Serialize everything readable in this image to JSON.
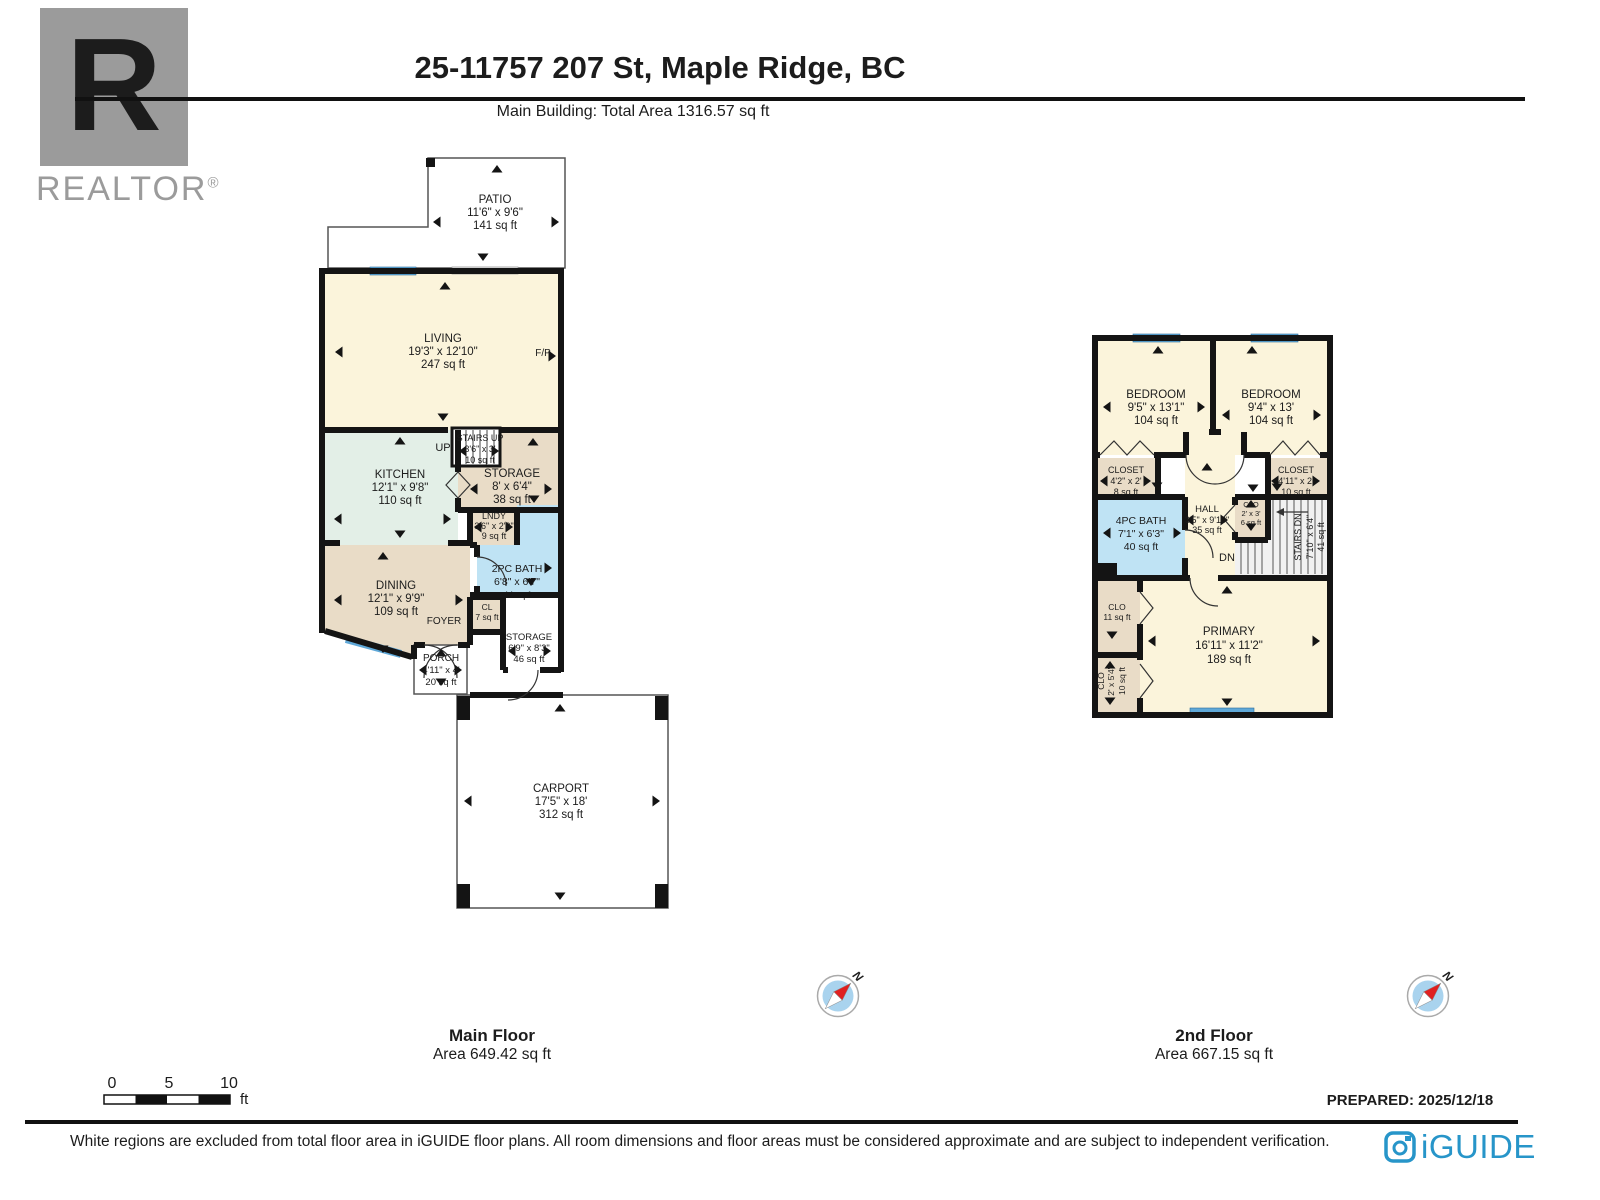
{
  "header": {
    "title": "25-11757 207 St, Maple Ridge, BC",
    "subtitle": "Main Building: Total Area 1316.57 sq ft"
  },
  "branding": {
    "realtor_r": "R",
    "realtor": "REALTOR",
    "reg": "®",
    "iguide": "iGUIDE"
  },
  "mf": {
    "label": "Main Floor",
    "area_label": "Area 649.42 sq ft",
    "patio": {
      "name": "PATIO",
      "dims": "11'6\" x 9'6\"",
      "area": "141 sq ft"
    },
    "living": {
      "name": "LIVING",
      "dims": "19'3\" x 12'10\"",
      "area": "247 sq ft"
    },
    "fp": "F/P",
    "kitchen": {
      "name": "KITCHEN",
      "dims": "12'1\" x 9'8\"",
      "area": "110 sq ft"
    },
    "stairs": {
      "name": "STAIRS UP",
      "dims": "3'6\" x 3'",
      "area": "10 sq ft",
      "dir": "UP"
    },
    "storage1": {
      "name": "STORAGE",
      "dims": "8' x 6'4\"",
      "area": "38 sq ft"
    },
    "lndy": {
      "name": "LNDY",
      "dims": "3'6\" x 2'9\"",
      "area": "9 sq ft"
    },
    "bath": {
      "name": "2PC BATH",
      "dims": "6'8\" x 6'7\"",
      "area": "44 sq ft"
    },
    "dining": {
      "name": "DINING",
      "dims": "12'1\" x 9'9\"",
      "area": "109 sq ft"
    },
    "foyer": "FOYER",
    "cl": {
      "name": "CL",
      "area": "7 sq ft"
    },
    "storage2": {
      "name": "STORAGE",
      "dims": "6'9\" x 8'3\"",
      "area": "46 sq ft"
    },
    "porch": {
      "name": "PORCH",
      "dims": "4'11\" x 4'",
      "area": "20 sq ft"
    },
    "carport": {
      "name": "CARPORT",
      "dims": "17'5\" x 18'",
      "area": "312 sq ft"
    }
  },
  "sf": {
    "label": "2nd Floor",
    "area_label": "Area 667.15 sq ft",
    "bed1": {
      "name": "BEDROOM",
      "dims": "9'5\" x 13'1\"",
      "area": "104 sq ft"
    },
    "bed2": {
      "name": "BEDROOM",
      "dims": "9'4\" x 13'",
      "area": "104 sq ft"
    },
    "closet1": {
      "name": "CLOSET",
      "dims": "4'2\" x 2'",
      "area": "8 sq ft"
    },
    "closet2": {
      "name": "CLOSET",
      "dims": "4'11\" x 2'",
      "area": "10 sq ft"
    },
    "bath": {
      "name": "4PC BATH",
      "dims": "7'1\" x 6'3\"",
      "area": "40 sq ft"
    },
    "hall": {
      "name": "HALL",
      "dims": "3'5\" x 9'10\"",
      "area": "35 sq ft"
    },
    "clo_c": {
      "name": "CLO",
      "dims": "2' x 3'",
      "area": "6 sq ft"
    },
    "stairs": {
      "name": "STAIRS DN",
      "dims": "7'10\" x 6'4\"",
      "area": "41 sq ft",
      "dir": "DN"
    },
    "primary": {
      "name": "PRIMARY",
      "dims": "16'11\" x 11'2\"",
      "area": "189 sq ft"
    },
    "clo_u": {
      "name": "CLO",
      "area": "11 sq ft"
    },
    "clo_l": {
      "name": "CLO",
      "dims": "2' x 5'4\"",
      "area": "10 sq ft"
    }
  },
  "compass": {
    "north": "N"
  },
  "scalebar": {
    "t0": "0",
    "t5": "5",
    "t10": "10",
    "unit": "ft"
  },
  "prepared": "PREPARED: 2025/12/18",
  "footer": "White regions are excluded from total floor area in iGUIDE floor plans. All room dimensions and floor areas must be considered approximate and are subject to independent verification.",
  "colors": {
    "cream": "#FBF4DB",
    "mint": "#E3EFE7",
    "tan": "#E9DCC7",
    "bath_blue": "#BFE3F4",
    "window_blue": "#5FA8D8",
    "wall": "#141414",
    "iguide_blue": "#2795C9",
    "realtor_gray": "#9B9B9B"
  }
}
